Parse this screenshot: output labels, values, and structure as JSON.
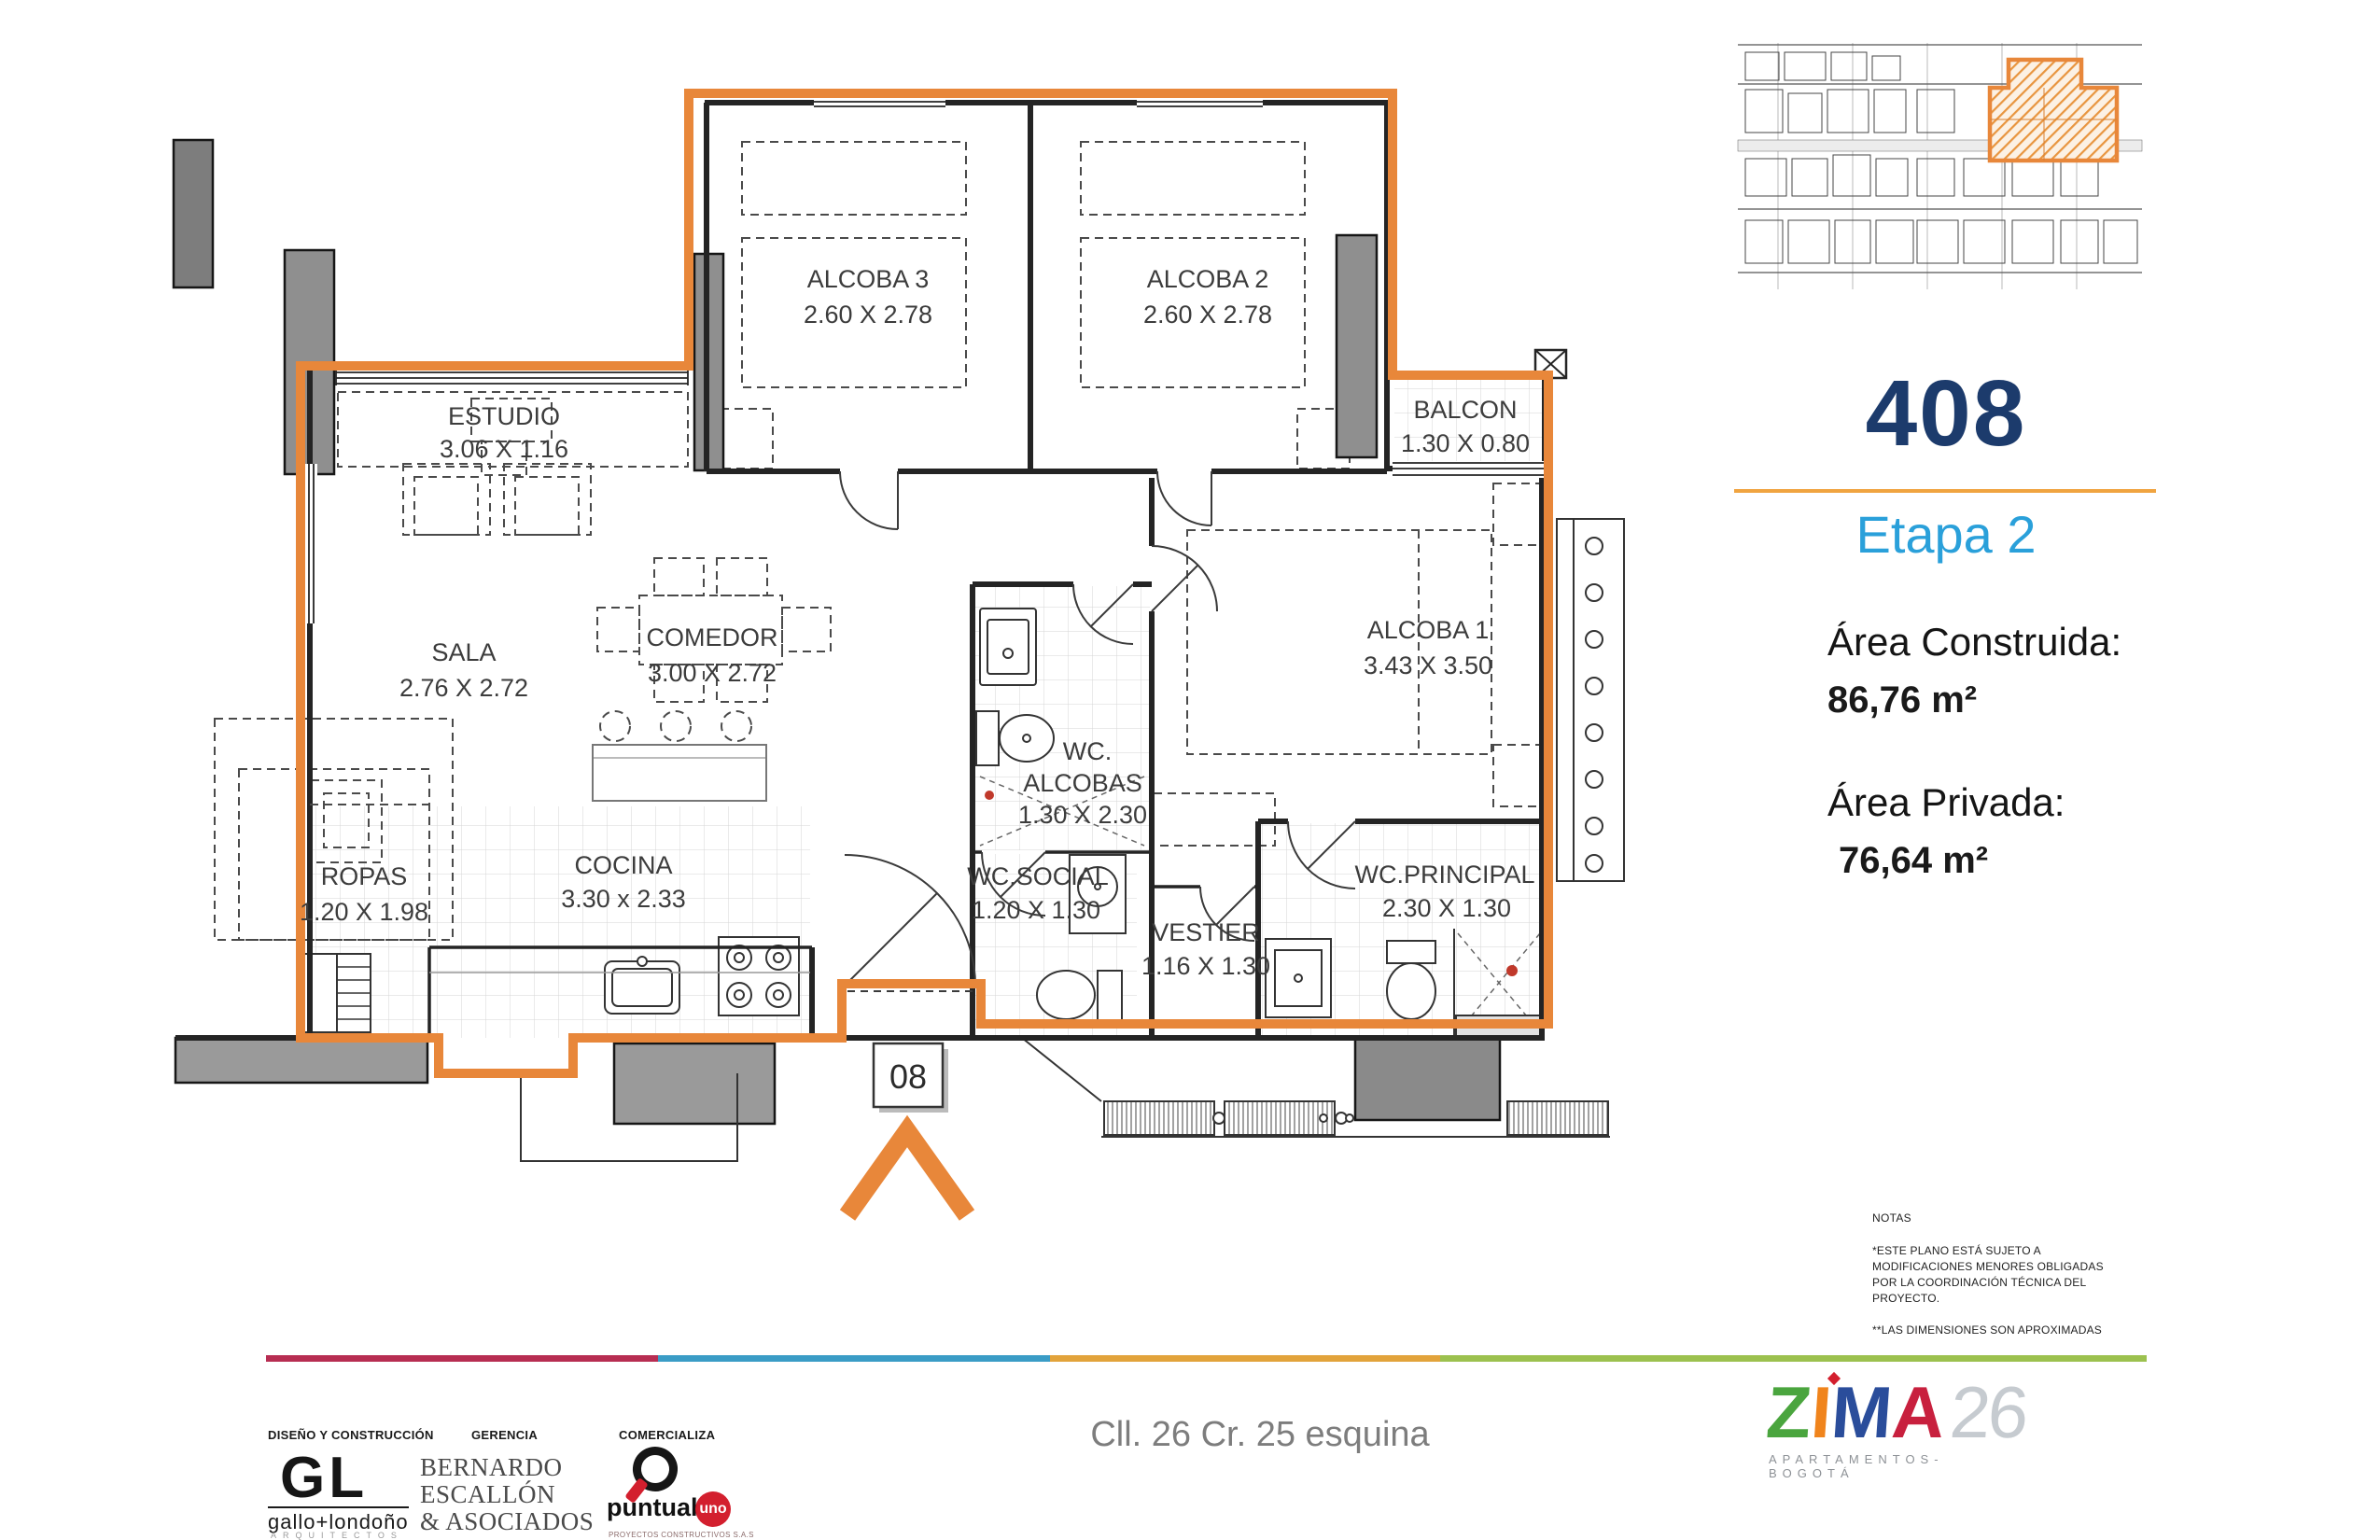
{
  "panel": {
    "number": "408",
    "etapa": "Etapa 2",
    "area_construida_label": "Área Construida:",
    "area_construida_value": "86,76 m²",
    "area_privada_label": "Área Privada:",
    "area_privada_value": "76,64 m²"
  },
  "rooms": {
    "estudio": {
      "name": "ESTUDIO",
      "dims": "3.06 X 1.16"
    },
    "alcoba3": {
      "name": "ALCOBA 3",
      "dims": "2.60 X 2.78"
    },
    "alcoba2": {
      "name": "ALCOBA 2",
      "dims": "2.60 X 2.78"
    },
    "balcon": {
      "name": "BALCON",
      "dims": "1.30 X 0.80"
    },
    "sala": {
      "name": "SALA",
      "dims": "2.76 X 2.72"
    },
    "comedor": {
      "name": "COMEDOR",
      "dims": "3.00 X 2.72"
    },
    "alcoba1": {
      "name": "ALCOBA 1",
      "dims": "3.43 X 3.50"
    },
    "wc_alcobas": {
      "name": "WC.",
      "name2": "ALCOBAS",
      "dims": "1.30 X 2.30"
    },
    "ropas": {
      "name": "ROPAS",
      "dims": "1.20 X 1.98"
    },
    "cocina": {
      "name": "COCINA",
      "dims": "3.30 x 2.33"
    },
    "wc_social": {
      "name": "WC.SOCIAL",
      "dims": "1.20 X 1.30"
    },
    "vestier": {
      "name": "VESTIER",
      "dims": "1.16 X 1.30"
    },
    "wc_principal": {
      "name": "WC.PRINCIPAL",
      "dims": "2.30 X 1.30"
    },
    "entry_tag": "08"
  },
  "notes": {
    "title": "NOTAS",
    "body": "*ESTE PLANO ESTÁ SUJETO A\nMODIFICACIONES MENORES OBLIGADAS\nPOR LA COORDINACIÓN TÉCNICA DEL\nPROYECTO.",
    "footnote": "**LAS DIMENSIONES SON APROXIMADAS"
  },
  "footer": {
    "address": "Cll. 26 Cr. 25 esquina",
    "design_role": "DISEÑO Y CONSTRUCCIÓN",
    "design_name": "GL",
    "design_sub": "gallo+londoño",
    "design_sub2": "ARQUITECTOS",
    "gerencia_role": "GERENCIA",
    "gerencia_name": "BERNARDO\nESCALLÓN\n& ASOCIADOS",
    "comercializa_role": "COMERCIALIZA",
    "comercializa_name": "puntual",
    "comercializa_accent": "uno",
    "comercializa_sub": "PROYECTOS CONSTRUCTIVOS S.A.S"
  },
  "brand": {
    "z": "Z",
    "i": "I",
    "m": "M",
    "a": "A",
    "number": "26",
    "tagline": "APARTAMENTOS-BOGOTÁ"
  },
  "colors": {
    "unit_outline": "#E8873A",
    "unit_number": "#1C3B6C",
    "etapa": "#2AA0DA",
    "underline": "#F0A440",
    "footer_bar": [
      "#B72D52",
      "#3A9CC6",
      "#E2A33B",
      "#9CC14F"
    ],
    "zima_letters": {
      "z": "#4AA53E",
      "i": "#F0841C",
      "m": "#2A4D9B",
      "a": "#C8203E",
      "num": "#C6CBD0"
    },
    "accent_red": "#D31F2E"
  }
}
